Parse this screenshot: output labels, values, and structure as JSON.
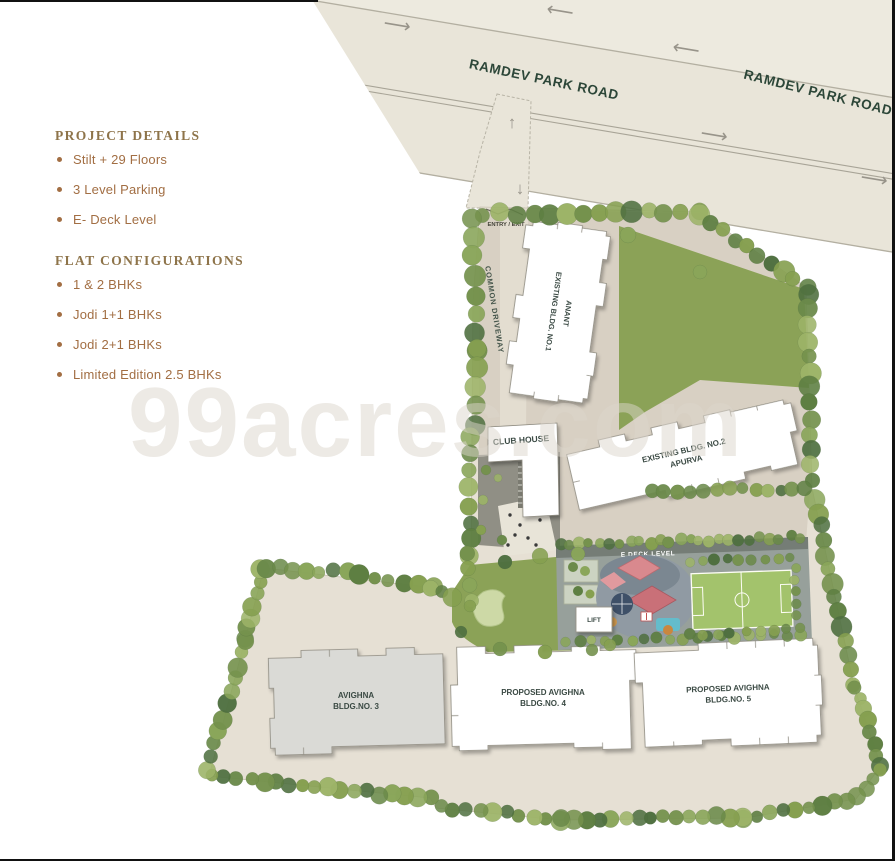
{
  "panel": {
    "project_details_title": "PROJECT DETAILS",
    "project_details_items": [
      "Stilt + 29 Floors",
      "3 Level Parking",
      "E- Deck Level"
    ],
    "flat_config_title": "FLAT CONFIGURATIONS",
    "flat_config_items": [
      "1 & 2 BHKs",
      "Jodi 1+1 BHKs",
      "Jodi 2+1 BHKs",
      "Limited Edition 2.5 BHKs"
    ]
  },
  "road": {
    "name": "RAMDEV PARK ROAD",
    "arrow_left": "⟵",
    "arrow_right": "⟶",
    "arrow_up": "↑",
    "arrow_down": "↓"
  },
  "site": {
    "entry_label": "ENTRY / EXIT",
    "driveway_label": "COMMON DRIVEWAY",
    "club_house_label": "CLUB HOUSE",
    "e_deck_label": "E DECK LEVEL",
    "lift_label": "LIFT",
    "buildings": {
      "bldg1": {
        "line1": "EXISTING BLDG. NO.1",
        "line2": "ANANT"
      },
      "bldg2": {
        "line1": "EXISTING BLDG. NO.2",
        "line2": "APURVA"
      },
      "bldg3": {
        "line1": "AVIGHNA",
        "line2": "BLDG.NO. 3"
      },
      "bldg4": {
        "line1": "PROPOSED AVIGHNA",
        "line2": "BLDG.NO. 4"
      },
      "bldg5": {
        "line1": "PROPOSED AVIGHNA",
        "line2": "BLDG.NO. 5"
      }
    }
  },
  "watermark": "99acres.com",
  "colors": {
    "heading_brown": "#8e744a",
    "bullet_brown": "#a26e43",
    "road_label_green": "#2c4638",
    "building_label": "#3b4a44",
    "lawn_green": "#8ba257",
    "site_beige": "#e6e0d4",
    "road_beige": "#e9e5d9",
    "deck_gray": "#97a09b",
    "court_green": "#a3c36c",
    "tree_green": "#75924d",
    "watermark_gray": "#d8d4c9"
  }
}
